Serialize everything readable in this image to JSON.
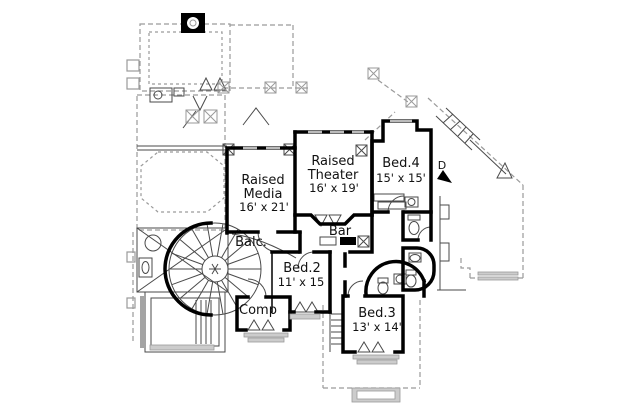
{
  "plan": {
    "type": "architectural-floor-plan",
    "floor": "second-floor",
    "colors": {
      "background": "#ffffff",
      "walls": "#000000",
      "detail": "#9a9a9a",
      "thin": "#4a4a4a",
      "sill": "#cccccc",
      "window": "#bbbbbb",
      "text": "#111111"
    },
    "rooms": {
      "raised_media": {
        "line1": "Raised",
        "line2": "Media",
        "dims": "16' x 21'"
      },
      "raised_theater": {
        "line1": "Raised",
        "line2": "Theater",
        "dims": "16' x 19'"
      },
      "bed4": {
        "name": "Bed.4",
        "dims": "15' x 15'"
      },
      "bed2": {
        "name": "Bed.2",
        "dims": "11' x 15"
      },
      "bed3": {
        "name": "Bed.3",
        "dims": "13' x 14'"
      },
      "balcony": {
        "name": "Balc."
      },
      "bar": {
        "name": "Bar"
      },
      "comp": {
        "name": "Comp"
      },
      "stairs": {
        "down_label": "D"
      }
    }
  }
}
